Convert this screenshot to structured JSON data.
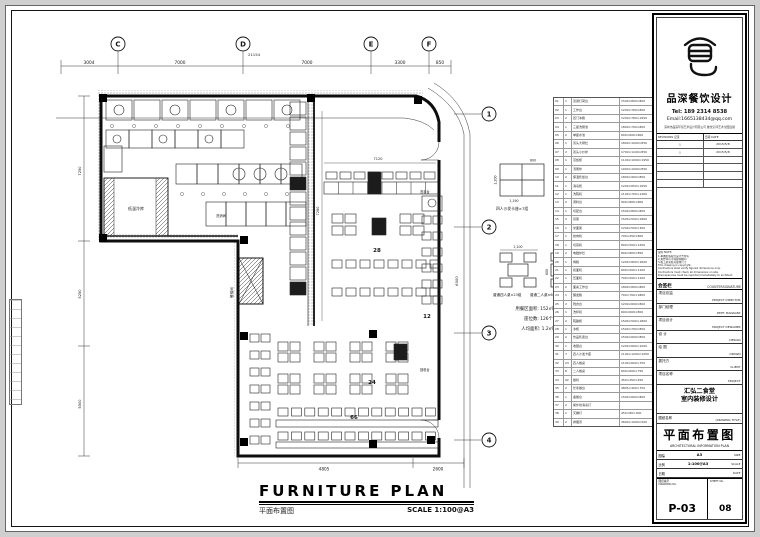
{
  "footer": {
    "title_en": "FURNITURE PLAN",
    "title_zh": "平面布置图",
    "scale": "SCALE 1:100@A3"
  },
  "grid": {
    "top_bubbles": [
      "C",
      "D",
      "E",
      "F"
    ],
    "top_dims": [
      "3004",
      "7000",
      "7000",
      "3300",
      "850"
    ],
    "total": "21154",
    "side_bubbles": [
      "1",
      "2",
      "3",
      "4"
    ]
  },
  "plan": {
    "labels": {
      "cold_room": "低温冷库",
      "lift": "餐梯间",
      "wash_basin": "洗手台",
      "wash_area": "洗消间",
      "dish_return": "回收台"
    },
    "counts": {
      "booth": "28",
      "right": "12",
      "center": "24",
      "bottom": "66"
    },
    "dims": {
      "top_inner": "7120",
      "left_inner": "7280",
      "left": [
        "7250",
        "5250",
        "5500"
      ],
      "bottom": [
        "4805",
        "2600"
      ],
      "side": "6000"
    }
  },
  "details": {
    "booth_caption": "四人沙发卡座×7组",
    "table4_caption": "普通四人桌×23组",
    "table2_caption": "普通二人桌×6组",
    "booth_dims": {
      "top": "600",
      "side": "1,200",
      "bottom": "1,190"
    },
    "table4_dim": "1,100",
    "table2_dim": "600",
    "stats": [
      "用餐区面积: 152㎡",
      "座位数: 126个",
      "人均面积: 1.2㎡"
    ]
  },
  "schedule": {
    "rows": [
      [
        "01",
        "1",
        "双通打荷台",
        "1500×800×800"
      ],
      [
        "02",
        "1",
        "工作台",
        "1200×760×800"
      ],
      [
        "03",
        "2",
        "四门冰箱",
        "1200×760×1950"
      ],
      [
        "04",
        "1",
        "三星洗刷池",
        "1800×700×800"
      ],
      [
        "05",
        "2",
        "单星水池",
        "600×600×800"
      ],
      [
        "06",
        "1",
        "双头大锅灶",
        "1800×1000×850"
      ],
      [
        "07",
        "2",
        "双头小炒炉",
        "1700×1100×850"
      ],
      [
        "08",
        "1",
        "蒸饭柜",
        "1100×1000×1950"
      ],
      [
        "09",
        "1",
        "汤粥炉",
        "1000×1000×850"
      ],
      [
        "10",
        "2",
        "保温售饭台",
        "1800×900×850"
      ],
      [
        "11",
        "1",
        "消毒柜",
        "1200×650×1950"
      ],
      [
        "12",
        "1",
        "洗碗机",
        "1100×700×1400"
      ],
      [
        "13",
        "2",
        "调料台",
        "900×800×800"
      ],
      [
        "14",
        "1",
        "切配台",
        "1500×800×800"
      ],
      [
        "15",
        "2",
        "货架",
        "1500×500×1800"
      ],
      [
        "16",
        "1",
        "米面架",
        "1200×500×300"
      ],
      [
        "17",
        "1",
        "绞肉机",
        "700×450×800"
      ],
      [
        "18",
        "1",
        "切菜机",
        "800×500×1250"
      ],
      [
        "19",
        "2",
        "电磁炉灶",
        "800×800×850"
      ],
      [
        "20",
        "1",
        "烤箱",
        "1200×800×1600"
      ],
      [
        "21",
        "1",
        "和面机",
        "600×500×1100"
      ],
      [
        "22",
        "1",
        "压面机",
        "700×500×1100"
      ],
      [
        "23",
        "2",
        "面案工作台",
        "1800×800×800"
      ],
      [
        "24",
        "1",
        "醒发箱",
        "700×700×1800"
      ],
      [
        "25",
        "2",
        "残食台",
        "1200×600×800"
      ],
      [
        "26",
        "1",
        "洗杯机",
        "600×600×800"
      ],
      [
        "27",
        "2",
        "碗碟柜",
        "1500×500×1800"
      ],
      [
        "28",
        "1",
        "冰柜",
        "1500×700×850"
      ],
      [
        "29",
        "2",
        "饮品售卖台",
        "1500×600×850"
      ],
      [
        "30",
        "1",
        "收银台",
        "1200×600×1000"
      ],
      [
        "31",
        "7",
        "四人沙发卡座",
        "1190×1200×1050"
      ],
      [
        "32",
        "23",
        "四人餐桌",
        "1100×600×750"
      ],
      [
        "33",
        "6",
        "二人餐桌",
        "600×600×750"
      ],
      [
        "34",
        "92",
        "餐椅",
        "450×450×450"
      ],
      [
        "35",
        "2",
        "长条餐台",
        "4805×400×750"
      ],
      [
        "36",
        "1",
        "备餐台",
        "1500×600×800"
      ],
      [
        "37",
        "2",
        "紫外线消毒灯",
        ""
      ],
      [
        "38",
        "1",
        "灭蝇灯",
        "450×80×300"
      ],
      [
        "39",
        "2",
        "排烟罩",
        "3600×1000×500"
      ],
      [
        "40",
        "1",
        "隔油池",
        "1000×500×400"
      ],
      [
        "41",
        "2",
        "洗手盆",
        "550×450×800"
      ],
      [
        "42",
        "1",
        "回收台",
        "1200×600×800"
      ],
      [
        "43",
        "2",
        "置物架",
        "1200×400×1800"
      ],
      [
        "44",
        "1",
        "饮水机",
        "350×350×1000"
      ]
    ]
  },
  "titleblock": {
    "brand": "品深餐饮设计",
    "tel": "Tel: 189 2314 8538",
    "email": "Email:1665138434@qq.com",
    "company": "深圳市品深环境艺术设计有限公司 餐饮空间艺术全国连锁",
    "revisions": {
      "header": [
        "REVISIONS 记录",
        "日期 DATE"
      ],
      "rows": [
        [
          "△",
          "2015/5/8"
        ],
        [
          "△",
          "2015/5/8"
        ],
        [
          "",
          ""
        ],
        [
          "",
          ""
        ],
        [
          "",
          ""
        ],
        [
          "",
          ""
        ]
      ]
    },
    "notes": [
      "说明 NOTE:",
      "1.本图纸版权归设计方所有",
      "2.未经许可不得复制翻印",
      "3.施工前须核对现场尺寸",
      "This drawing is copyright.",
      "Contractors shall verify figured dimensions only.",
      "Contractors must check all dimensions on site.",
      "Discrepancies must be reported immediately to architect."
    ],
    "countersign": {
      "zh": "会签栏",
      "en": "COUNTERSIGNATURE"
    },
    "sign_rows": [
      [
        "项目总监",
        "PROJECT DIRECTOR"
      ],
      [
        "部门经理",
        "DEPT. MANAGER"
      ],
      [
        "项目设计",
        "PROJECT DESIGNER"
      ],
      [
        "设 计",
        "DESIGN"
      ],
      [
        "绘 图",
        "DRAWN"
      ],
      [
        "委托方",
        "CLIENT"
      ]
    ],
    "project": {
      "label_zh": "项目名称",
      "label_en": "PROJECT",
      "line1": "汇弘二食堂",
      "line2": "室内装修设计"
    },
    "drawing_title": {
      "label_zh": "图纸名称",
      "label_en": "(DRAWING TITLE)",
      "zh": "平面布置图",
      "en": "ARCHITECTURAL INFORMATION PLAN"
    },
    "meta_rows": [
      [
        "图幅",
        "SIZE",
        "A3"
      ],
      [
        "比例",
        "SCALE",
        "1:100@A3"
      ],
      [
        "日期",
        "DATE",
        ""
      ]
    ],
    "number": {
      "zh": "图纸编号",
      "en": "DRAWING No.",
      "value": "P-03"
    },
    "sheet_no": {
      "en": "SHEET No.",
      "value": "08"
    }
  }
}
